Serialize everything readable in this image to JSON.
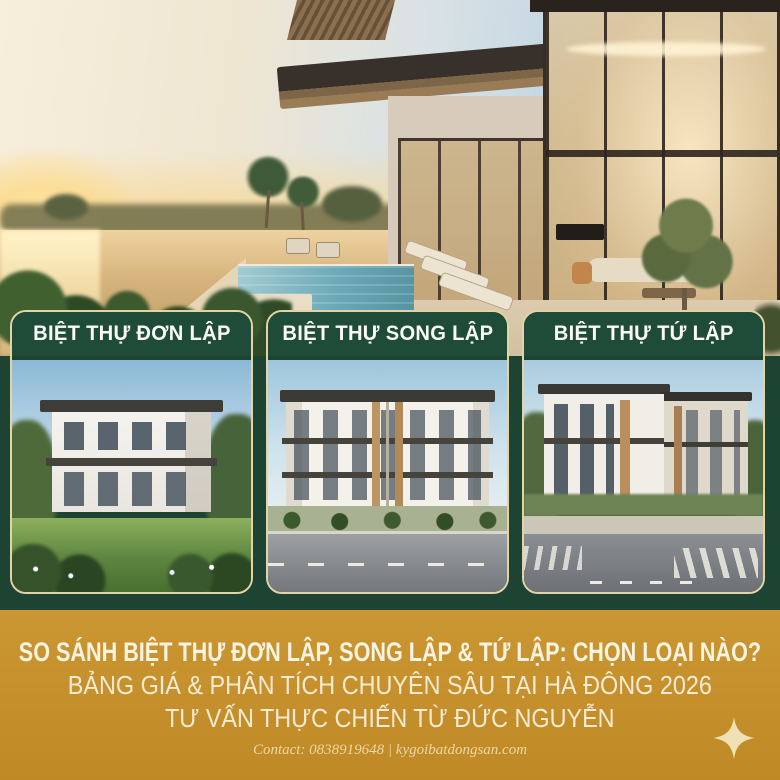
{
  "poster": {
    "cards": [
      {
        "label": "BIỆT THỰ ĐƠN LẬP"
      },
      {
        "label": "BIỆT THỰ SONG LẬP"
      },
      {
        "label": "BIỆT THỰ TỨ LẬP"
      }
    ],
    "banner": {
      "title": "SO SÁNH BIỆT THỰ ĐƠN LẬP, SONG LẬP & TỨ LẬP: CHỌN LOẠI NÀO?",
      "line2": "BẢNG GIÁ & PHÂN TÍCH CHUYÊN SÂU TẠI HÀ ĐÔNG 2026",
      "line3": "TƯ VẤN THỰC CHIẾN TỪ ĐỨC NGUYỄN",
      "contact": "Contact: 0838919648 | kygoibatdongsan.com"
    },
    "icons": {
      "sparkle": "four-point-star"
    },
    "colors": {
      "gold": "#c6912e",
      "deep_green": "#1d4432",
      "header_green": "#1f4c38",
      "cream": "#f5eed8",
      "cream_muted": "#ecd8a4",
      "card_border": "#e2d4a6"
    }
  }
}
